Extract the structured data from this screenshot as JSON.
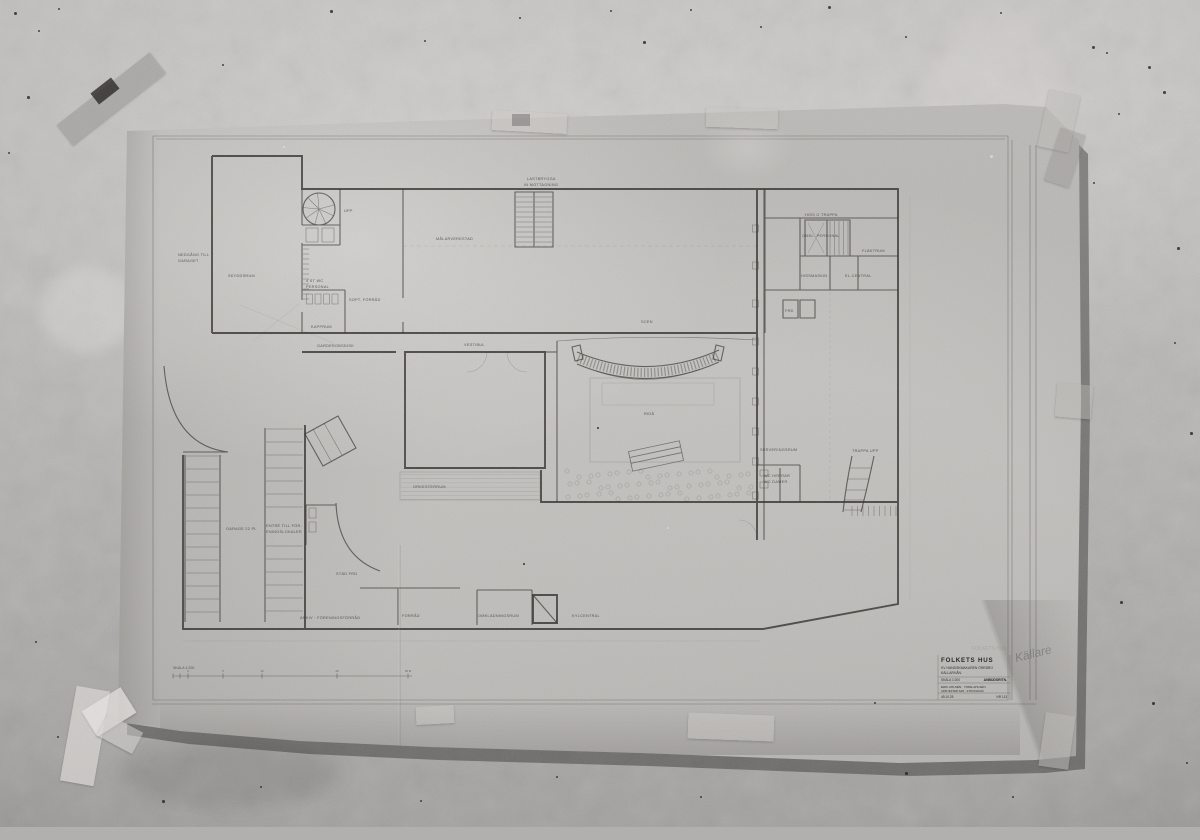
{
  "sheet": {
    "handwritten_note": "Källare"
  },
  "title_block": {
    "project": "FOLKETS HUS",
    "address": "KV HANDSKMAKAREN ÖREBRO",
    "floor": "KÄLLARVÅN.",
    "scale": "SKALA 1:200",
    "stamp": "ANBUDSRITN.",
    "architects": "ERIK AHLSÉN · TORE AHLSÉN",
    "firm": "ARKITEKTER SAR · STOCKHOLM",
    "date": "49.10.25",
    "number": "NR 113"
  },
  "scale_bar": {
    "label": "SKALA 1:200",
    "ticks": [
      {
        "v": "",
        "x": 173
      },
      {
        "v": "",
        "x": 180
      },
      {
        "v": "0",
        "x": 188
      },
      {
        "v": "5",
        "x": 223
      },
      {
        "v": "10",
        "x": 262
      },
      {
        "v": "20",
        "x": 337
      },
      {
        "v": "30 M",
        "x": 408
      }
    ]
  },
  "plan": {
    "labels": [
      {
        "t": "LASTBRYGGA",
        "x": 527,
        "y": 180
      },
      {
        "t": "IN MOTTAGNING",
        "x": 524,
        "y": 186
      },
      {
        "t": "NEDGÅNG TILL",
        "x": 178,
        "y": 256
      },
      {
        "t": "GARAGET",
        "x": 178,
        "y": 262
      },
      {
        "t": "SKYDDSRUM",
        "x": 228,
        "y": 277
      },
      {
        "t": "4 ST WC",
        "x": 306,
        "y": 282
      },
      {
        "t": "PERSONAL",
        "x": 306,
        "y": 288
      },
      {
        "t": "SOPT. FÖRRÅD",
        "x": 349,
        "y": 301
      },
      {
        "t": "KAPPRUM",
        "x": 311,
        "y": 328
      },
      {
        "t": "GARDEROBSDISK",
        "x": 317,
        "y": 347
      },
      {
        "t": "VESTIBUL",
        "x": 464,
        "y": 346
      },
      {
        "t": "MÅLARVERKSTAD",
        "x": 436,
        "y": 240
      },
      {
        "t": "UPP",
        "x": 344,
        "y": 212
      },
      {
        "t": "HISS O TRAPPA",
        "x": 805,
        "y": 216
      },
      {
        "t": "OMKL. PERSONAL",
        "x": 802,
        "y": 237
      },
      {
        "t": "FLÄKTRUM",
        "x": 862,
        "y": 252
      },
      {
        "t": "HISSMASKIN",
        "x": 801,
        "y": 277
      },
      {
        "t": "EL-CENTRAL",
        "x": 845,
        "y": 277
      },
      {
        "t": "FRD",
        "x": 785,
        "y": 312
      },
      {
        "t": "SCEN",
        "x": 641,
        "y": 323
      },
      {
        "t": "RIDÅ",
        "x": 644,
        "y": 415
      },
      {
        "t": "ORKESTERRUM",
        "x": 413,
        "y": 488
      },
      {
        "t": "SERVERINGSRUM",
        "x": 760,
        "y": 451
      },
      {
        "t": "WC HERRAR",
        "x": 764,
        "y": 477
      },
      {
        "t": "WC DAMER",
        "x": 764,
        "y": 483
      },
      {
        "t": "TRAPPA UPP",
        "x": 852,
        "y": 452
      },
      {
        "t": "GARAGE 22 PL",
        "x": 226,
        "y": 530
      },
      {
        "t": "ENTRÉ TILL FÖR-",
        "x": 266,
        "y": 527
      },
      {
        "t": "ENINGSLOKALER",
        "x": 266,
        "y": 533
      },
      {
        "t": "STÄD FRD",
        "x": 336,
        "y": 575
      },
      {
        "t": "FÖRRÅD",
        "x": 402,
        "y": 617
      },
      {
        "t": "OMKLÄDNINGSRUM",
        "x": 478,
        "y": 617
      },
      {
        "t": "KYLCENTRAL",
        "x": 572,
        "y": 617
      },
      {
        "t": "ARKIV · FÖRENINGSFÖRRÅD",
        "x": 300,
        "y": 619
      }
    ]
  }
}
